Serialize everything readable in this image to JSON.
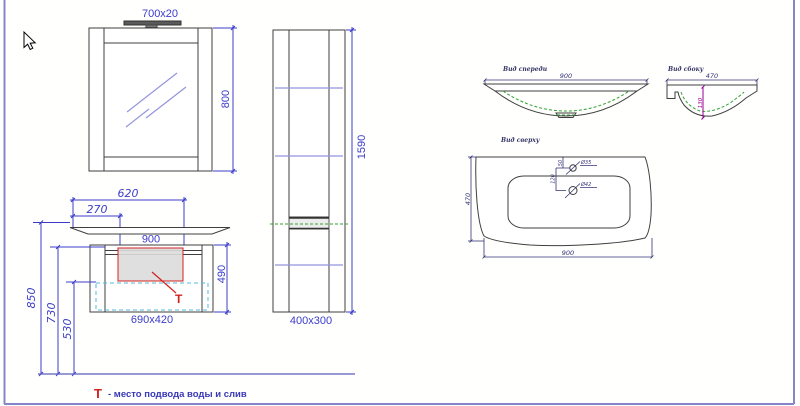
{
  "colors": {
    "dimension_blue": "#3c3ccc",
    "shelf_blue": "#9494dd",
    "outline_gray": "#3f3f3f",
    "marking_red": "#d42020",
    "bowl_green": "#33a033",
    "zone_cyan": "#55b8e0",
    "depth_magenta": "#990099",
    "view_navy": "#333377",
    "frame_violet": "#8585cc"
  },
  "mirror": {
    "lamp_dim": "700x20",
    "height": "800"
  },
  "tall_cabinet": {
    "height": "1590",
    "footprint": "400x300"
  },
  "vanity": {
    "dim_620": "620",
    "dim_270": "270",
    "dim_900": "900",
    "dim_490": "490",
    "footprint": "690x420",
    "t_marker": "T"
  },
  "wall_dims": {
    "d850": "850",
    "d730": "730",
    "d530": "530"
  },
  "legend": {
    "marker": "T",
    "text": "- место подвода воды и слив"
  },
  "front_view": {
    "label": "Вид спереди",
    "width": "900"
  },
  "side_view": {
    "label": "Вид сбоку",
    "width": "470",
    "depth": "130"
  },
  "top_view": {
    "label": "Вид сверху",
    "width": "900",
    "depth": "470",
    "faucet_hole": "Ø35",
    "drain_hole": "Ø42",
    "dim_50": "50",
    "dim_120": "120"
  }
}
